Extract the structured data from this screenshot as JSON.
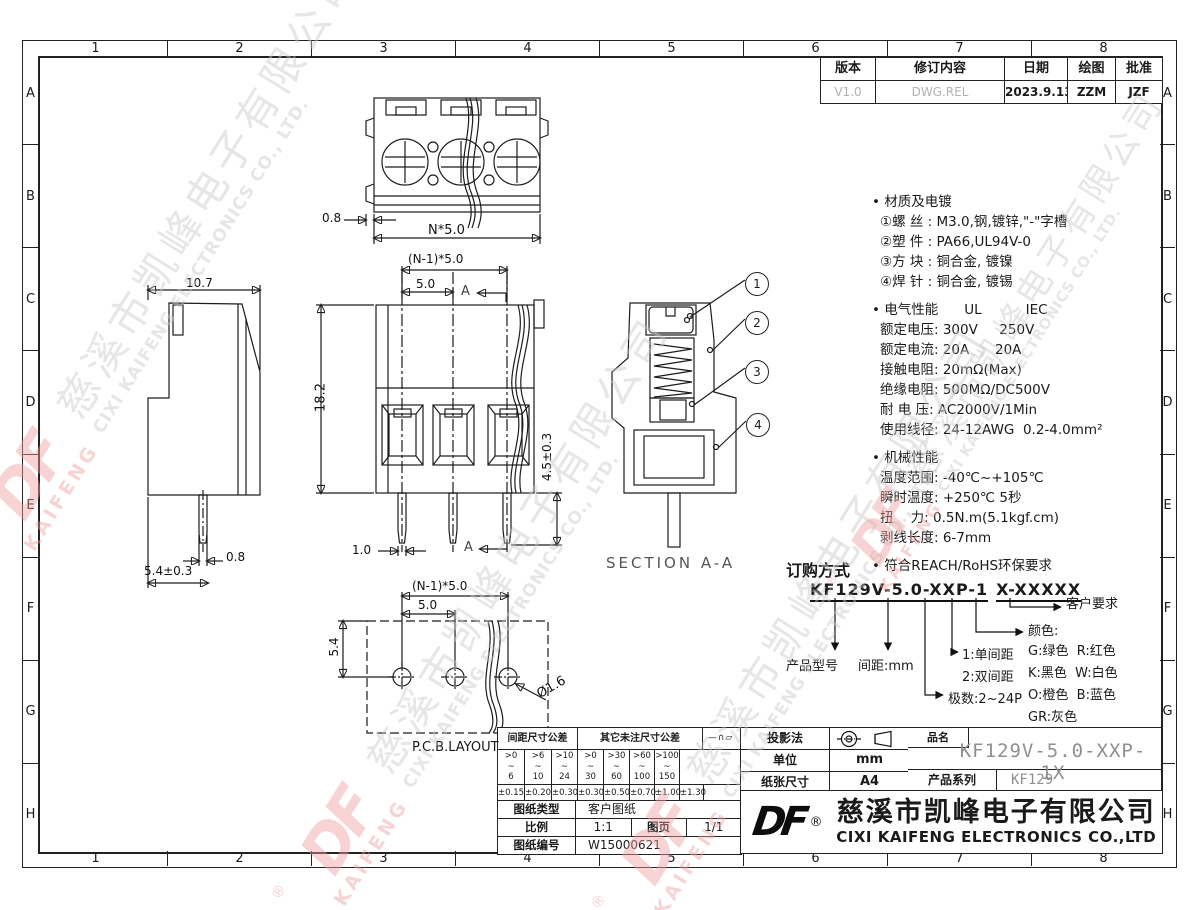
{
  "zones": {
    "cols": [
      "1",
      "2",
      "3",
      "4",
      "5",
      "6",
      "7",
      "8"
    ],
    "rows": [
      "A",
      "B",
      "C",
      "D",
      "E",
      "F",
      "G",
      "H"
    ]
  },
  "revision_table": {
    "headers": [
      "版本",
      "修订内容",
      "日期",
      "绘图",
      "批准"
    ],
    "values": [
      "V1.0",
      "DWG.REL",
      "2023.9.13",
      "ZZM",
      "JZF"
    ]
  },
  "dims": {
    "top_width": "0.8",
    "top_pitch": "N*5.0",
    "front_pitch_total": "(N-1)*5.0",
    "front_pitch": "5.0",
    "front_height": "18.2",
    "front_pin_length": "4.5±0.3",
    "front_pin_width": "1.0",
    "section_mark": "A",
    "side_depth": "10.7",
    "side_pin_width": "0.8",
    "side_pin_length": "5.4±0.3",
    "section_label": "SECTION A-A",
    "pcb_pitch_total": "(N-1)*5.0",
    "pcb_pitch": "5.0",
    "pcb_edge": "5.4",
    "pcb_hole": "Ø1.6",
    "pcb_label": "P.C.B.LAYOUT"
  },
  "section_callouts": [
    "1",
    "2",
    "3",
    "4"
  ],
  "notes": {
    "material": {
      "title": "材质及电镀",
      "lines": [
        "①螺 丝 : M3.0,钢,镀锌,\"-\"字槽",
        "②塑 件 : PA66,UL94V-0",
        "③方 块 : 铜合金, 镀镍",
        "④焊 针 : 铜合金, 镀锡"
      ]
    },
    "electrical": {
      "title": "电气性能",
      "std1": "UL",
      "std2": "IEC",
      "lines": [
        "额定电压: 300V     250V",
        "额定电流: 20A      20A",
        "接触电阻: 20mΩ(Max)",
        "绝缘电阻: 500MΩ/DC500V",
        "耐 电 压: AC2000V/1Min",
        "使用线径: 24-12AWG  0.2-4.0mm²"
      ]
    },
    "mechanical": {
      "title": "机械性能",
      "lines": [
        "温度范围: -40℃~+105℃",
        "瞬时温度: +250℃ 5秒",
        "扭    力: 0.5N.m(5.1kgf.cm)",
        "剥线长度: 6-7mm"
      ]
    },
    "compliance": "符合REACH/RoHS环保要求"
  },
  "ordering": {
    "title": "订购方式",
    "code_main": "KF129V-5.0-XXP-1",
    "code_suffix": "X-XXXXX",
    "model_label": "产品型号",
    "pitch_label": "间距:mm",
    "poles_label": "极数:2~24P",
    "row_single": "1:单间距",
    "row_double": "2:双间距",
    "color_label": "颜色:",
    "color_lines": [
      "G:绿色  R:红色",
      "K:黑色  W:白色",
      "O:橙色  B:蓝色",
      "GR:灰色"
    ],
    "customer_label": "客户要求"
  },
  "tolerance_table": {
    "pitch_header": "间距尺寸公差",
    "other_header": "其它未注尺寸公差",
    "symbols_header": "—∩▱",
    "ranges": [
      ">0\n~\n6",
      ">6\n~\n10",
      ">10\n~\n24",
      ">0\n~\n30",
      ">30\n~\n60",
      ">60\n~\n100",
      ">100\n~\n150"
    ],
    "range_last": ">150",
    "flatness": "0.1/10",
    "angle_symbol": "∠",
    "tolerances": [
      "±0.15",
      "±0.20",
      "±0.30",
      "±0.30",
      "±0.50",
      "±0.70",
      "±1.00",
      "±1.30"
    ],
    "angle_tolerance": "±2°"
  },
  "info_table": {
    "type_label": "图纸类型",
    "type_value": "客户图纸",
    "scale_label": "比例",
    "scale_value": "1:1",
    "page_label": "图页",
    "page_value": "1/1",
    "number_label": "图纸编号",
    "number_value": "W15000621"
  },
  "title_block": {
    "projection_label": "投影法",
    "unit_label": "单位",
    "unit_value": "mm",
    "paper_label": "纸张尺寸",
    "paper_value": "A4",
    "part_label": "品名",
    "part_value": "KF129V-5.0-XXP-1X",
    "series_label": "产品系列",
    "series_value": "KF129",
    "logo": "DF",
    "reg": "®",
    "company_cn": "慈溪市凯峰电子有限公司",
    "company_en": "CIXI KAIFENG ELECTRONICS CO.,LTD"
  },
  "watermark": {
    "reg": "®",
    "logo": "DF",
    "logo_sub": "KAIFENG",
    "cn": "慈溪市凯峰电子有限公司",
    "en": "CIXI KAIFENG ELECTRONICS CO., LTD.",
    "pink": "#ef9f9f",
    "gray": "#c9c9c9"
  }
}
